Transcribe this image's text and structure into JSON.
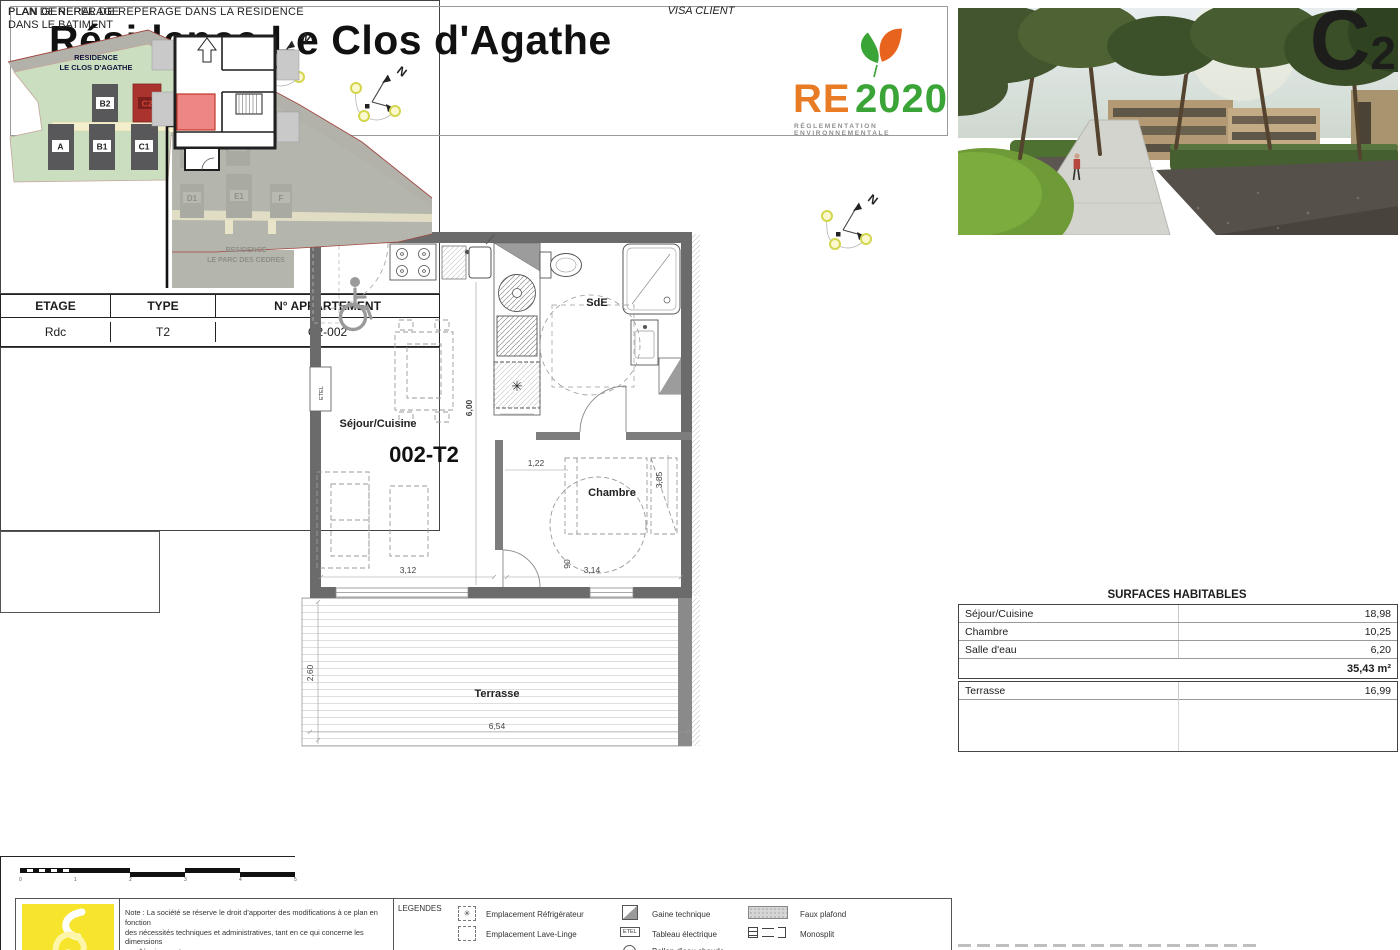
{
  "header": {
    "title": "Résidence Le Clos d'Agathe",
    "address": "Chemin du petit Pioch 34300 AGDE"
  },
  "re2020": {
    "re": "RE",
    "year": "2020",
    "subtitle": "RÉGLEMENTATION ENVIRONNEMENTALE",
    "orange": "#e87c24",
    "green": "#3aa437"
  },
  "compass": {
    "north": "N"
  },
  "floor_plan": {
    "marker_label": "C2-002",
    "marker_color": "#cc1a1e",
    "unit_code": "002-T2",
    "rooms": {
      "sejour": "Séjour/Cuisine",
      "sde": "SdE",
      "chambre": "Chambre",
      "terrasse": "Terrasse"
    },
    "labels": {
      "etel": "ETEL"
    },
    "dims": {
      "height_total": "6,00",
      "sejour_width": "3,12",
      "hall": "1,22",
      "chambre_height": "3,85",
      "door": "90",
      "chambre_width": "3,14",
      "terrasse_height": "2,60",
      "terrasse_width": "6,54"
    },
    "icons": {
      "fridge_star": "✳"
    }
  },
  "site_plan": {
    "title": "PLAN GENERAL DE REPERAGE DANS LA RESIDENCE",
    "sheet_letter": "C",
    "sheet_index": "2",
    "residence_main_line1": "RESIDENCE",
    "residence_main_line2": "LE CLOS D'AGATHE",
    "residence_other_line1": "RESIDENCE",
    "residence_other_line2": "LE PARC DES CEDRES",
    "buildings_main": [
      "B2",
      "C2",
      "A",
      "B1",
      "C1"
    ],
    "buildings_other": [
      "D2",
      "E2",
      "D1",
      "E1",
      "F"
    ],
    "highlighted_building": "C2",
    "colors": {
      "site_green": "#cbdfc0",
      "site_gray": "#b4b6ad",
      "building_dark": "#58585a",
      "building_red": "#aa332e",
      "path_cream": "#f3efcc",
      "pool_blue": "#8fb9de"
    }
  },
  "info_table": {
    "headers": {
      "etage": "ETAGE",
      "type": "TYPE",
      "apartment": "N° APPARTEMENT"
    },
    "values": {
      "etage": "Rdc",
      "type": "T2",
      "apartment": "C2-002"
    }
  },
  "surfaces": {
    "title": "SURFACES HABITABLES",
    "rows": [
      {
        "label": "Séjour/Cuisine",
        "value": "18,98"
      },
      {
        "label": "Chambre",
        "value": "10,25"
      },
      {
        "label": "Salle d'eau",
        "value": "6,20"
      }
    ],
    "total": "35,43 m²",
    "terrasse": {
      "label": "Terrasse",
      "value": "16,99"
    }
  },
  "building_plan": {
    "title_line1": "PLAN DE REPERAGE",
    "title_line2": "DANS LE BATIMENT"
  },
  "visa": {
    "label": "VISA CLIENT"
  },
  "note": {
    "line1": "Note : La société se réserve le droit d'apporter des modifications à ce plan en fonction",
    "line2": "des nécessités techniques et administratives, tant en ce qui concerne les dimensions",
    "line3": "que l'équipement.",
    "line4": "Les retombées, faux plafonds, soffites sont donnés à titre indicatif.",
    "line5": "Les côtes et les surfaces données, le sont sous réserve des impératifs de construction"
  },
  "legend": {
    "title": "LEGENDES",
    "items": [
      {
        "label": "Emplacement Réfrigérateur"
      },
      {
        "label": "Emplacement Lave-Linge"
      },
      {
        "label": "Gaine technique"
      },
      {
        "label": "Tableau électrique",
        "icon_text": "ETEL"
      },
      {
        "label": "Ballon d'eau chaude"
      },
      {
        "label": "Faux plafond"
      },
      {
        "label": "Monosplit"
      }
    ]
  },
  "scale_bar": {
    "ticks": [
      "0",
      "1",
      "2",
      "3",
      "4",
      "5"
    ]
  }
}
